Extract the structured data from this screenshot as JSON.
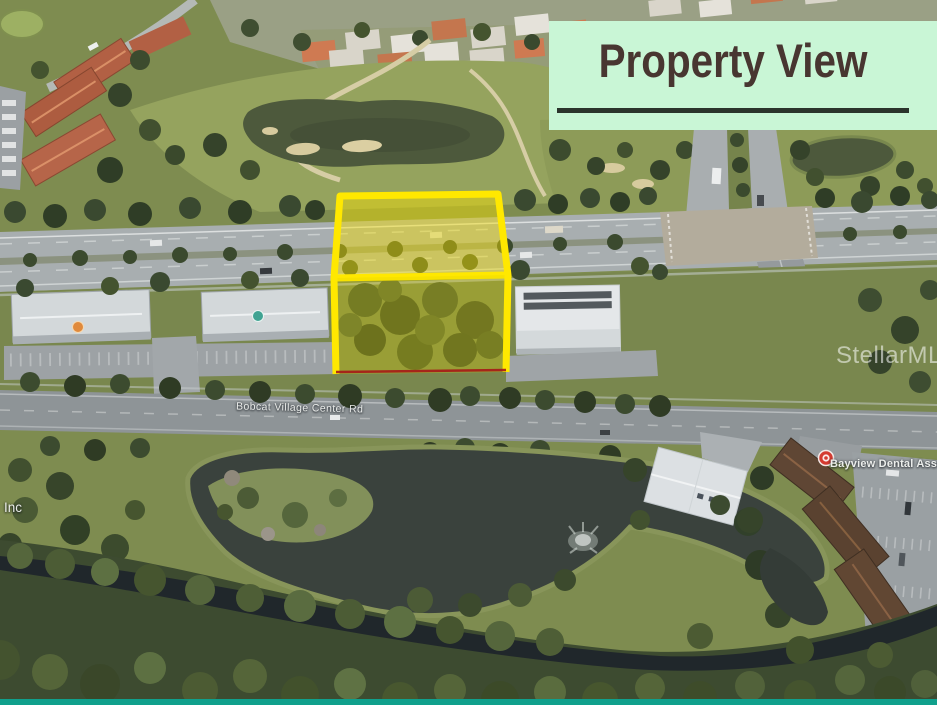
{
  "banner": {
    "title": "Property View",
    "background_color": "#c9f6d6",
    "text_color": "#483631",
    "underline_color": "#2b342c"
  },
  "map": {
    "street_label": "Bobcat Village Center Rd",
    "business_label": "Bayview Dental Asso",
    "partial_business_label": "Inc",
    "watermark": "StellarMLS"
  },
  "overlay": {
    "parcel_outline_color": "#ffe800",
    "parcel_fill_top_opacity": 0.45,
    "parcel_fill_bottom_opacity": 0.3,
    "parcel_front_line_color": "#a61717"
  },
  "icons": {
    "poi_pin": "red-map-pin-icon",
    "poi_dot_orange": "orange-poi-dot",
    "poi_dot_teal": "teal-cupola-dot"
  },
  "accents": {
    "bottom_strip_color": "#10a08c",
    "water_color": "#3a423d",
    "golf_grass_color": "#8d9b58"
  }
}
